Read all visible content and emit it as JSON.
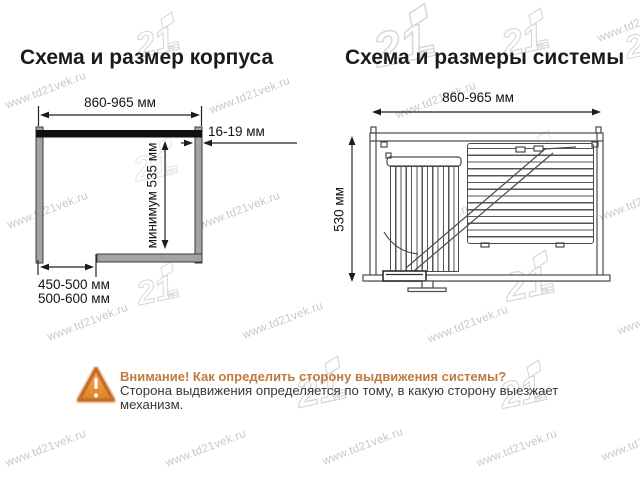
{
  "watermark": {
    "text": "www.td21vek.ru",
    "logo_text": "21"
  },
  "left_diagram": {
    "title": "Схема и размер корпуса",
    "width_dim": "860-965 мм",
    "panel_thickness_dim": "16-19 мм",
    "height_dim": "минимум 535 мм",
    "depth_dim_line1": "450-500 мм",
    "depth_dim_line2": "500-600 мм"
  },
  "right_diagram": {
    "title": "Схема и размеры системы",
    "width_dim": "860-965 мм",
    "height_dim": "530 мм"
  },
  "warning": {
    "title": "Внимание! Как определить сторону выдвижения системы?",
    "body_line1": "Сторона выдвижения определяется по тому, в какую сторону выезжает",
    "body_line2": "механизм."
  },
  "colors": {
    "accent_orange": "#bf7a3e",
    "watermark_gray": "#c8c8c8",
    "diagram_line": "#4a4a4a"
  }
}
